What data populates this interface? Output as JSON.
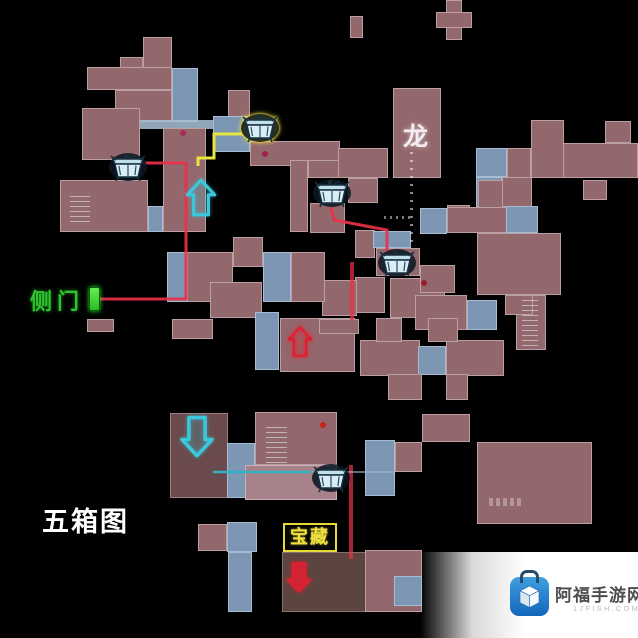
{
  "labels": {
    "dragon_room": "龙",
    "side_door": "侧门",
    "five_box_map": "五箱图",
    "treasure": "宝藏"
  },
  "watermark": {
    "site_name": "阿福手游网",
    "site_domain": "17FISH.COM",
    "logo": "blue-bag-cube-icon"
  },
  "colors": {
    "background": "#000000",
    "room_fill": "#93686d",
    "room_dark_fill": "#6a4a4c",
    "treasure_room_fill": "#5c453f",
    "room_light_fill": "#a8828a",
    "corridor_fill": "#7d96b4",
    "route_red": "#e83048",
    "route_yellow": "#e6e63e",
    "route_teal": "#2fb3c4",
    "arrow_cyan": "#3cc8dc",
    "arrow_red": "#e21f32",
    "door_green": "#3ee03e",
    "side_door_text_green": "#2ec42e",
    "treasure_box_yellow": "#e8d838",
    "watermark_blue": "#2286d8"
  },
  "markers": {
    "chests": [
      {
        "id": "chest-1",
        "x": 128,
        "y": 167,
        "selected": false
      },
      {
        "id": "chest-2",
        "x": 260,
        "y": 128,
        "selected": true
      },
      {
        "id": "chest-3",
        "x": 332,
        "y": 193,
        "selected": false
      },
      {
        "id": "chest-4",
        "x": 397,
        "y": 263,
        "selected": false
      },
      {
        "id": "chest-5",
        "x": 331,
        "y": 478,
        "selected": false
      }
    ],
    "arrows": [
      {
        "id": "stairs-up-cyan",
        "direction": "up",
        "color": "cyan",
        "style": "outline",
        "x": 201,
        "y": 198,
        "w": 32,
        "h": 40
      },
      {
        "id": "stairs-up-red",
        "direction": "up",
        "color": "red",
        "style": "outline",
        "x": 300,
        "y": 342,
        "w": 26,
        "h": 36
      },
      {
        "id": "stairs-down-cyan",
        "direction": "down",
        "color": "cyan",
        "style": "outline",
        "x": 197,
        "y": 436,
        "w": 36,
        "h": 44
      },
      {
        "id": "stairs-down-red",
        "direction": "down",
        "color": "red",
        "style": "solid",
        "x": 299,
        "y": 577,
        "w": 26,
        "h": 36
      }
    ],
    "side_door_marker": {
      "x": 89,
      "y": 287
    }
  }
}
